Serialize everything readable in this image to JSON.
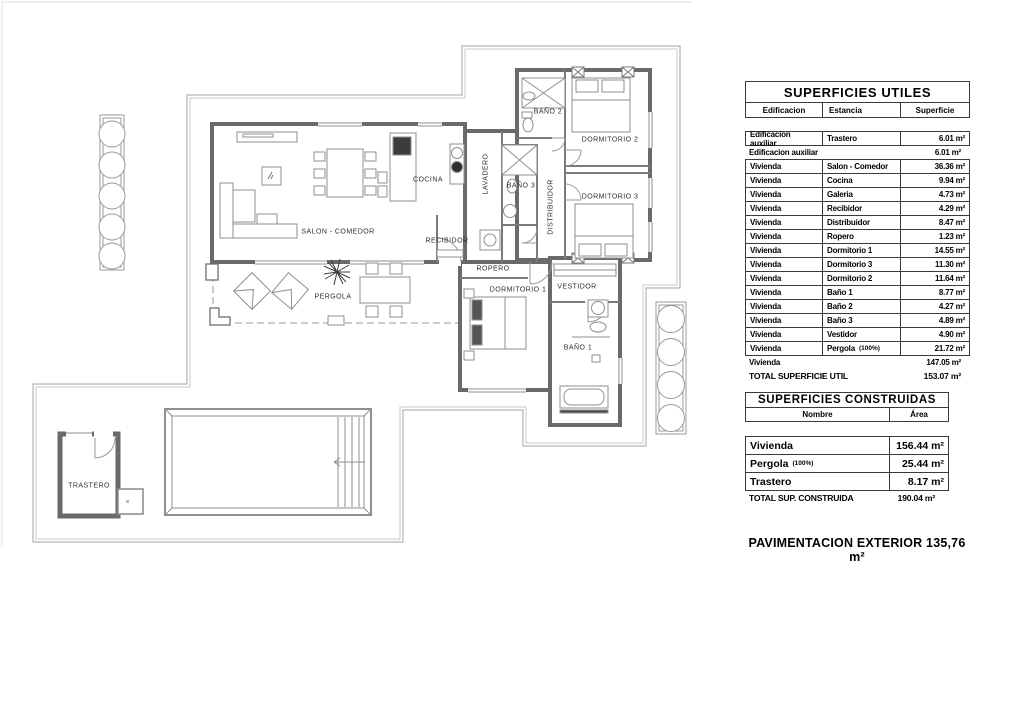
{
  "plan": {
    "labels": {
      "salon_comedor": "SALON - COMEDOR",
      "cocina": "COCINA",
      "recibidor": "RECIBIDOR",
      "lavadero": "LAVADERO",
      "bano2": "BAÑO 2",
      "dormitorio2": "DORMITORIO 2",
      "bano3": "BAÑO 3",
      "distribuidor": "DISTRIBUIDOR",
      "dormitorio3": "DORMITORIO 3",
      "ropero": "ROPERO",
      "dormitorio1": "DORMITORIO 1",
      "vestidor": "VESTIDOR",
      "bano1": "BAÑO 1",
      "pergola": "PERGOLA",
      "trastero": "TRASTERO"
    },
    "line_color": "#6a6a6a",
    "boundary_color": "#b3b3b3",
    "furniture_color": "#8f8f8f"
  },
  "tables": {
    "utiles": {
      "title": "SUPERFICIES UTILES",
      "columns": [
        "Edificacion",
        "Estancia",
        "Superficie"
      ],
      "box1_rows": [
        {
          "edificacion": "Edificacion auxiliar",
          "estancia": "Trastero",
          "superficie": "6.01 m²"
        }
      ],
      "subtotal1": {
        "label": "Edificacion auxiliar",
        "value": "6.01 m²"
      },
      "box2_rows": [
        {
          "edificacion": "Vivienda",
          "estancia": "Salon - Comedor",
          "superficie": "36.36 m²"
        },
        {
          "edificacion": "Vivienda",
          "estancia": "Cocina",
          "superficie": "9.94 m²"
        },
        {
          "edificacion": "Vivienda",
          "estancia": "Galeria",
          "superficie": "4.73 m²"
        },
        {
          "edificacion": "Vivienda",
          "estancia": "Recibidor",
          "superficie": "4.29 m²"
        },
        {
          "edificacion": "Vivienda",
          "estancia": "Distribuidor",
          "superficie": "8.47 m²"
        },
        {
          "edificacion": "Vivienda",
          "estancia": "Ropero",
          "superficie": "1.23 m²"
        },
        {
          "edificacion": "Vivienda",
          "estancia": "Dormitorio 1",
          "superficie": "14.55 m²"
        },
        {
          "edificacion": "Vivienda",
          "estancia": "Dormitorio 3",
          "superficie": "11.30 m²"
        },
        {
          "edificacion": "Vivienda",
          "estancia": "Dormitorio 2",
          "superficie": "11.64 m²"
        },
        {
          "edificacion": "Vivienda",
          "estancia": "Baño 1",
          "superficie": "8.77 m²"
        },
        {
          "edificacion": "Vivienda",
          "estancia": "Baño 2",
          "superficie": "4.27 m²"
        },
        {
          "edificacion": "Vivienda",
          "estancia": "Baño 3",
          "superficie": "4.89 m²"
        },
        {
          "edificacion": "Vivienda",
          "estancia": "Vestidor",
          "superficie": "4.90 m²"
        },
        {
          "edificacion": "Vivienda",
          "estancia": "Pergola",
          "estancia_note": "(100%)",
          "superficie": "21.72 m²"
        }
      ],
      "subtotal2": {
        "label": "Vivienda",
        "value": "147.05 m²"
      },
      "total": {
        "label": "TOTAL SUPERFICIE UTIL",
        "value": "153.07 m²"
      }
    },
    "construidas": {
      "title": "SUPERFICIES CONSTRUIDAS",
      "columns": [
        "Nombre",
        "Área"
      ],
      "rows": [
        {
          "nombre": "Vivienda",
          "area": "156.44 m²"
        },
        {
          "nombre": "Pergola",
          "nombre_note": "(100%)",
          "area": "25.44 m²"
        },
        {
          "nombre": "Trastero",
          "area": "8.17 m²"
        }
      ],
      "total": {
        "label": "TOTAL SUP. CONSTRUIDA",
        "value": "190.04 m²"
      }
    },
    "footer": "PAVIMENTACION EXTERIOR 135,76 m²"
  }
}
